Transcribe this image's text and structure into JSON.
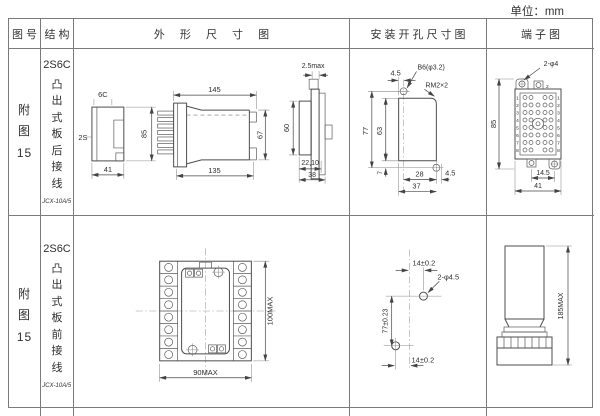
{
  "unit_label": "单位：mm",
  "table": {
    "headers": [
      "图 号",
      "结 构",
      "外 形 尺 寸 图",
      "安装开孔尺寸图",
      "端子图"
    ]
  },
  "rows": [
    {
      "fig_lines": [
        "附",
        "图",
        "15"
      ],
      "structure": {
        "model": "2S6C",
        "mount": "凸出式板后接线",
        "relay_type": "JCX-10A/5"
      },
      "outline": {
        "front": {
          "width_top": "6C",
          "depth_left": "2S",
          "height": "85",
          "width_bottom": "41"
        },
        "side": {
          "length_top": "145",
          "length_bottom": "135",
          "height_right": "67"
        },
        "panel": {
          "gap_top": "2.5max",
          "height_left": "60",
          "depth_bottom": "22,10",
          "width_bottom": "38"
        }
      },
      "install": {
        "offset_top": "4.5",
        "hole_label": "B6(φ3.2)",
        "corner_label": "RM2×2",
        "height_outer": "77",
        "height_inner": "63",
        "offset_bottom": "7",
        "width_inner": "28",
        "width_outer": "37",
        "offset_right": "4.5"
      },
      "terminal": {
        "hole_label": "2-φ4",
        "height": "85",
        "pitch": "14.5",
        "width": "41",
        "top_pin": "2",
        "pin_numbers": [
          "1",
          "2",
          "3",
          "4",
          "5",
          "6",
          "7",
          "8"
        ]
      }
    },
    {
      "fig_lines": [
        "附",
        "图",
        "15"
      ],
      "structure": {
        "model": "2S6C",
        "mount": "凸出式板前接线",
        "relay_type": "JCX-10A/5"
      },
      "outline": {
        "width": "90MAX",
        "height": "100MAX"
      },
      "install": {
        "offset_top": "14±0.2",
        "hole_label": "2-φ4.5",
        "height": "77±0.23",
        "offset_bottom": "14±0.2"
      },
      "terminal": {
        "height": "185MAX"
      }
    }
  ]
}
